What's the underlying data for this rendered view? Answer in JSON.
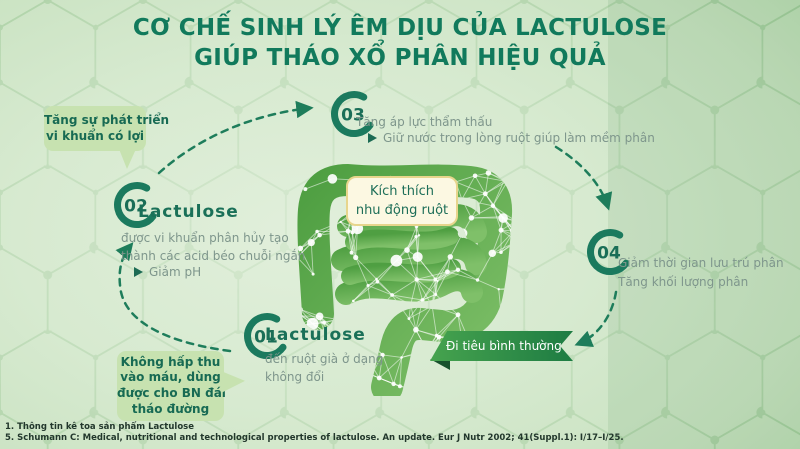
{
  "title": {
    "line1": "CƠ CHẾ SINH LÝ ÊM DỊU CỦA LACTULOSE",
    "line2": "GIÚP THÁO XỔ PHÂN HIỆU QUẢ"
  },
  "steps": {
    "s1": {
      "number": "01",
      "heading": "Lactulose",
      "line1": "đến ruột già ở dạng",
      "line2": "không đổi"
    },
    "s2": {
      "number": "02",
      "heading": "Lactulose",
      "line1": "được vi khuẩn phân hủy tạo",
      "line2": "thành các acid béo chuỗi ngắn",
      "bullet": "Giảm pH"
    },
    "s3": {
      "number": "03",
      "line1": "Tăng áp lực thẩm thấu",
      "bullet": "Giữ nước trong lòng ruột giúp làm mềm phân"
    },
    "s4": {
      "number": "04",
      "line1": "Giảm thời gian lưu trú phân",
      "line2": "Tăng khối lượng phân"
    }
  },
  "callouts": {
    "growth": {
      "line1": "Tăng sự phát triển",
      "line2": "vi khuẩn có lợi"
    },
    "absorption": {
      "line1": "Không hấp thu",
      "line2": "vào máu, dùng",
      "line3": "được cho BN đái",
      "line4": "tháo đường"
    }
  },
  "center_box": {
    "line1": "Kích thích",
    "line2": "nhu động ruột"
  },
  "ribbon": {
    "label": "Đi tiêu bình thường"
  },
  "footnotes": {
    "line1": "1. Thông tin kê toa sản phẩm Lactulose",
    "line2": "5. Schumann C: Medical, nutritional and technological properties of lactulose. An update. Eur J Nutr 2002; 41(Suppl.1): I/17–I/25."
  },
  "colors": {
    "accent_dark": "#117a5c",
    "ring": "#1b7a5e",
    "body_text": "#7e968c",
    "callout_bg": "#c7e2b0",
    "cream_box_bg": "#fcf8e2",
    "ribbon_start": "#46a34e",
    "ribbon_end": "#1e7c43"
  }
}
